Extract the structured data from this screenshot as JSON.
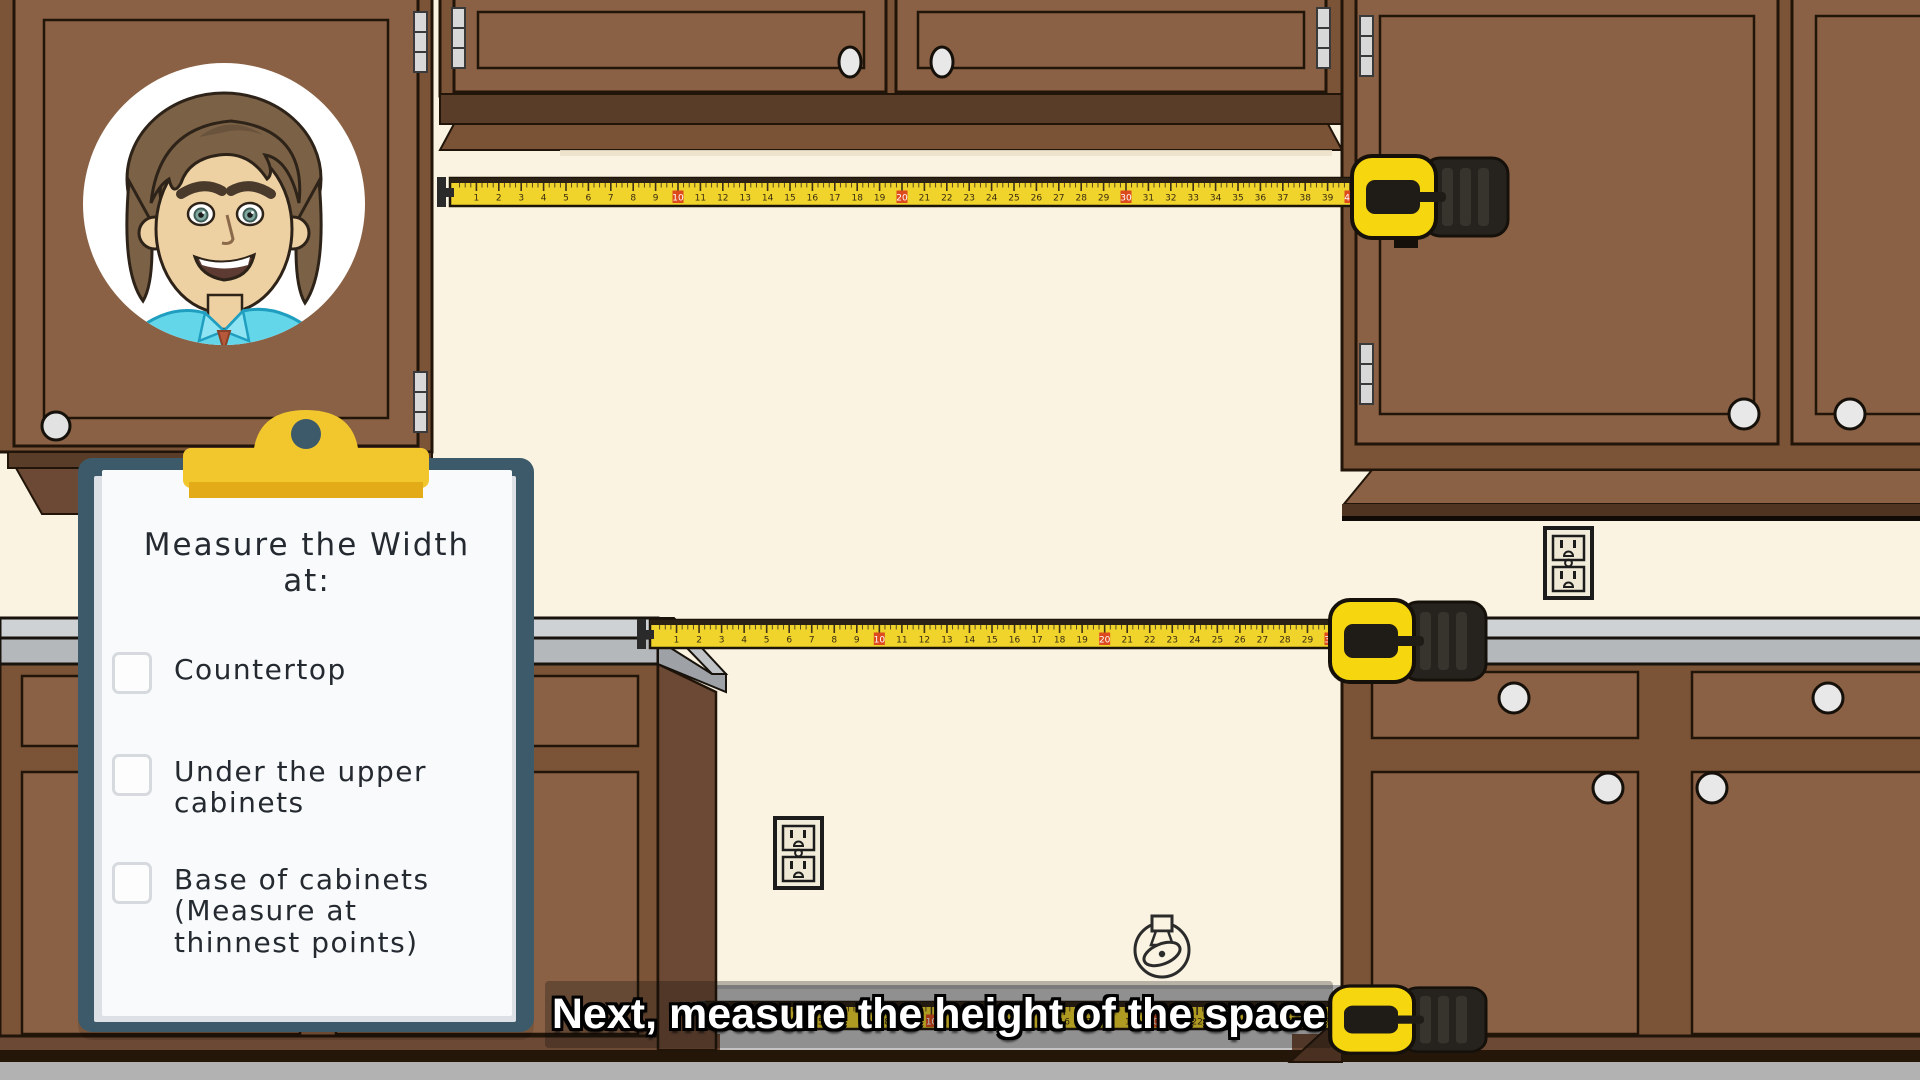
{
  "scene": {
    "type": "instructional cartoon kitchen scene",
    "caption": "Next, measure the height of the space"
  },
  "clipboard": {
    "title_lines": [
      "Measure the Width",
      "at:"
    ],
    "items": [
      {
        "label": "Countertop",
        "lines": [
          "Countertop"
        ],
        "checked": false
      },
      {
        "label": "Under the upper cabinets",
        "lines": [
          "Under the upper",
          "cabinets"
        ],
        "checked": false
      },
      {
        "label": "Base of cabinets (Measure at thinnest points)",
        "lines": [
          "Base of cabinets",
          "(Measure at",
          "thinnest points)"
        ],
        "checked": false
      }
    ]
  },
  "tapes": [
    {
      "id": "tape-under-upper-cabinets",
      "units": 40,
      "red_every": 10
    },
    {
      "id": "tape-countertop",
      "units": 30,
      "red_every": 10
    },
    {
      "id": "tape-base-of-cabinets",
      "units": 28,
      "red_every": 10
    }
  ],
  "icons": {
    "outlet": "power-outlet",
    "gas_valve": "gas-valve-icon",
    "avatar": "presenter-avatar"
  },
  "colors": {
    "wall": "#faf3e1",
    "cabinet_face": "#8a6144",
    "cabinet_frame": "#7b5438",
    "cabinet_dark_band": "#5a3d29",
    "outline": "#211409",
    "countertop_top": "#cfd2d5",
    "countertop_face": "#b4b8bb",
    "floor": "#b2b2b2",
    "alcove_floor": "#c4c4c4",
    "tape_yellow": "#f0d32b",
    "tape_red": "#dc4a1e",
    "case_yellow": "#f6d70f",
    "case_black": "#26231e",
    "clipboard_board": "#3c5a6a",
    "paper": "#f8fafc",
    "clip_yellow": "#f2c72e",
    "clip_yellow_dark": "#e3ab18",
    "shirt": "#63d6ea",
    "skin": "#eed1a3",
    "hair": "#7b6146"
  }
}
